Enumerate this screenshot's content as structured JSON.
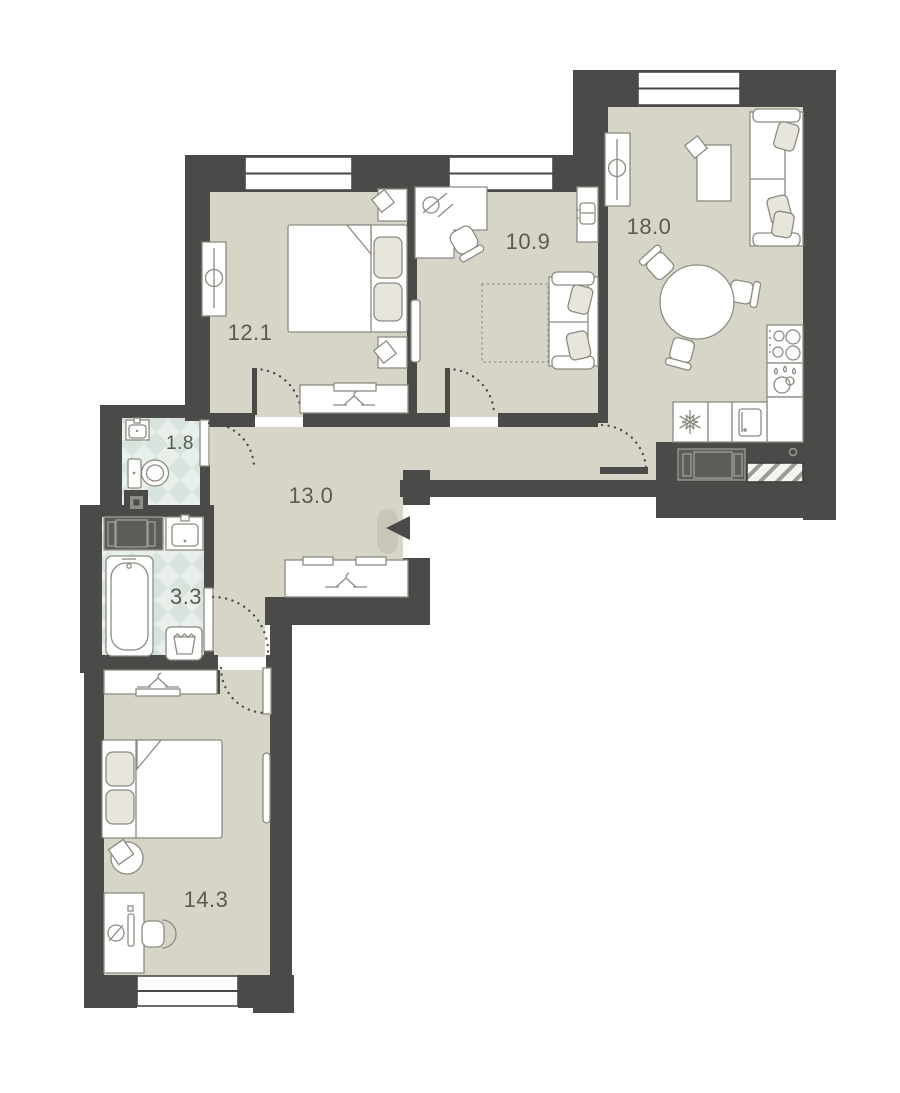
{
  "plan": {
    "title": "apartment-floor-plan",
    "rooms": [
      {
        "id": "bedroom-1",
        "label": "12.1"
      },
      {
        "id": "office",
        "label": "10.9"
      },
      {
        "id": "living-kitchen",
        "label": "18.0"
      },
      {
        "id": "wc",
        "label": "1.8"
      },
      {
        "id": "hallway",
        "label": "13.0"
      },
      {
        "id": "bathroom",
        "label": "3.3"
      },
      {
        "id": "bedroom-2",
        "label": "14.3"
      }
    ],
    "colors": {
      "wall": "#4a4a48",
      "floor": "#d7d5c7",
      "tile": "#e9efea",
      "tile_accent": "#d7e3dc",
      "furniture_outline": "#8c8c83",
      "accent_fill": "#e7e5dc",
      "label_text": "#5b5b54",
      "entry_door_leaf": "#c9c7ba"
    }
  }
}
